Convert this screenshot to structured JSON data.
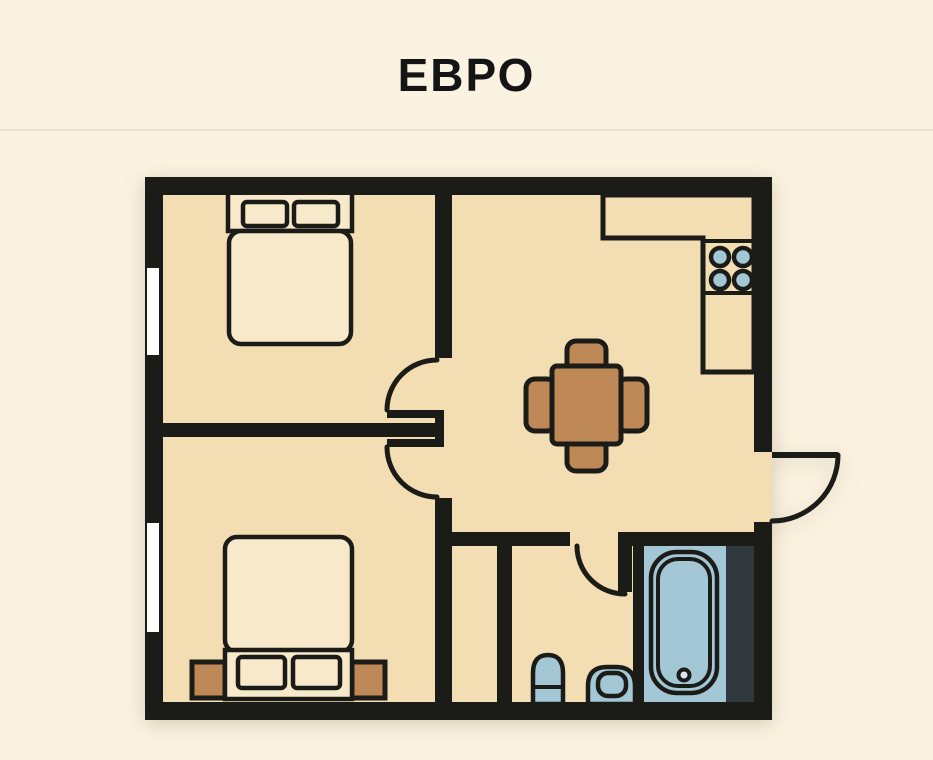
{
  "page": {
    "title": "ЕВРО",
    "width": 933,
    "height": 760
  },
  "colors": {
    "page-bg": "#FBF3E2",
    "floor": "#F3DDB2",
    "wall": "#1B1B17",
    "furniture-cream": "#F8E9CA",
    "fixture-blue": "#A4C7D6",
    "wood-brown": "#BE8957",
    "dark-panel": "#2E383D",
    "window-white": "#FFFFFF",
    "divider": "#EDE4D2",
    "title-color": "#141414"
  },
  "plan": {
    "layout_name": "euro apartment floor plan",
    "rooms": [
      {
        "name": "bedroom-top",
        "furniture": [
          "double-bed",
          "two-pillows"
        ]
      },
      {
        "name": "bedroom-bottom",
        "furniture": [
          "double-bed",
          "two-pillows",
          "nightstand-left",
          "nightstand-right"
        ]
      },
      {
        "name": "kitchen-living-room",
        "furniture": [
          "l-shaped-counter",
          "stove-4-burners",
          "dining-table",
          "four-chairs"
        ]
      },
      {
        "name": "bathroom",
        "furniture": [
          "bathtub",
          "sink",
          "toilet"
        ]
      },
      {
        "name": "closet-niche",
        "furniture": []
      }
    ],
    "doors": [
      "bedroom-top-door",
      "bedroom-bottom-door",
      "bathroom-door",
      "entrance-door"
    ],
    "windows": [
      "bedroom-top-window",
      "bedroom-bottom-window"
    ]
  }
}
